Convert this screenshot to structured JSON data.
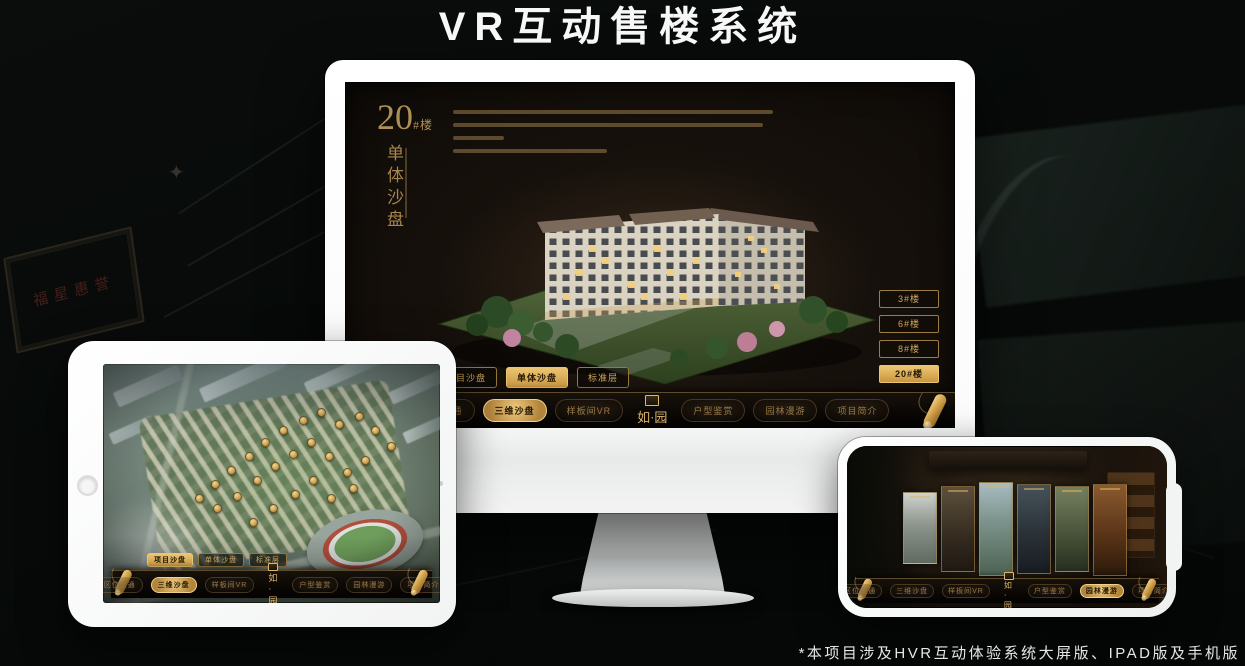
{
  "page": {
    "title": "VR互动售楼系统",
    "footnote": "*本项目涉及HVR互动体验系统大屏版、IPAD版及手机版"
  },
  "background": {
    "plaque_text": "福星惠誉"
  },
  "logo": {
    "text": "如·园"
  },
  "nav_items": [
    "区位交通",
    "三维沙盘",
    "样板间VR",
    "户型鉴赏",
    "园林漫游",
    "项目简介"
  ],
  "monitor": {
    "title_number": "20",
    "title_suffix": "#楼",
    "title_sub": "单体沙盘",
    "building_buttons": [
      {
        "label": "3#楼",
        "selected": false
      },
      {
        "label": "6#楼",
        "selected": false
      },
      {
        "label": "8#楼",
        "selected": false
      },
      {
        "label": "20#楼",
        "selected": true
      }
    ],
    "tabs": [
      {
        "label": "项目沙盘",
        "selected": false
      },
      {
        "label": "单体沙盘",
        "selected": true
      },
      {
        "label": "标准层",
        "selected": false
      }
    ],
    "nav_active_index": 1
  },
  "tablet": {
    "tabs": [
      {
        "label": "项目沙盘",
        "selected": true
      },
      {
        "label": "单体沙盘",
        "selected": false
      },
      {
        "label": "标准层",
        "selected": false
      }
    ],
    "nav_active_index": 1
  },
  "phone": {
    "nav_active_index": 4
  },
  "colors": {
    "gold": "#c9a25e",
    "gold_bright": "#ecc573",
    "gold_dark": "#8a7248",
    "screen_bg": "#17110c"
  }
}
